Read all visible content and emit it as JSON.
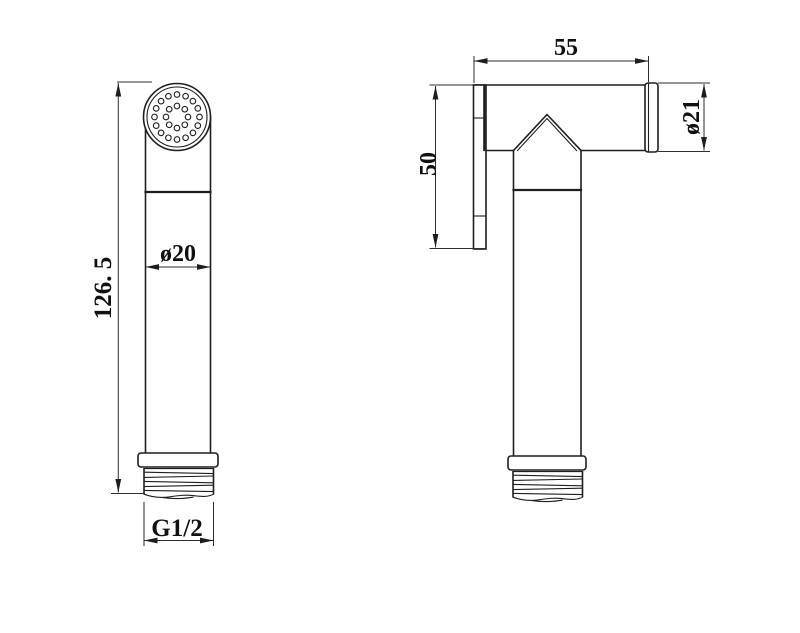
{
  "colors": {
    "background": "#ffffff",
    "line": "#1f1f1f",
    "dim": "#2e2e2e",
    "text": "#101010"
  },
  "drawing": {
    "type": "technical-dimension-drawing",
    "subject": "handheld-sprayer",
    "front_view": {
      "dim_height": "126. 5",
      "dim_head_diameter": "ø20",
      "dim_thread": "G1/2",
      "spray_holes": {
        "outer_count": 16,
        "inner_count": 8
      }
    },
    "side_view": {
      "dim_length": "55",
      "dim_face_height": "50",
      "dim_body_diameter": "ø21"
    }
  }
}
